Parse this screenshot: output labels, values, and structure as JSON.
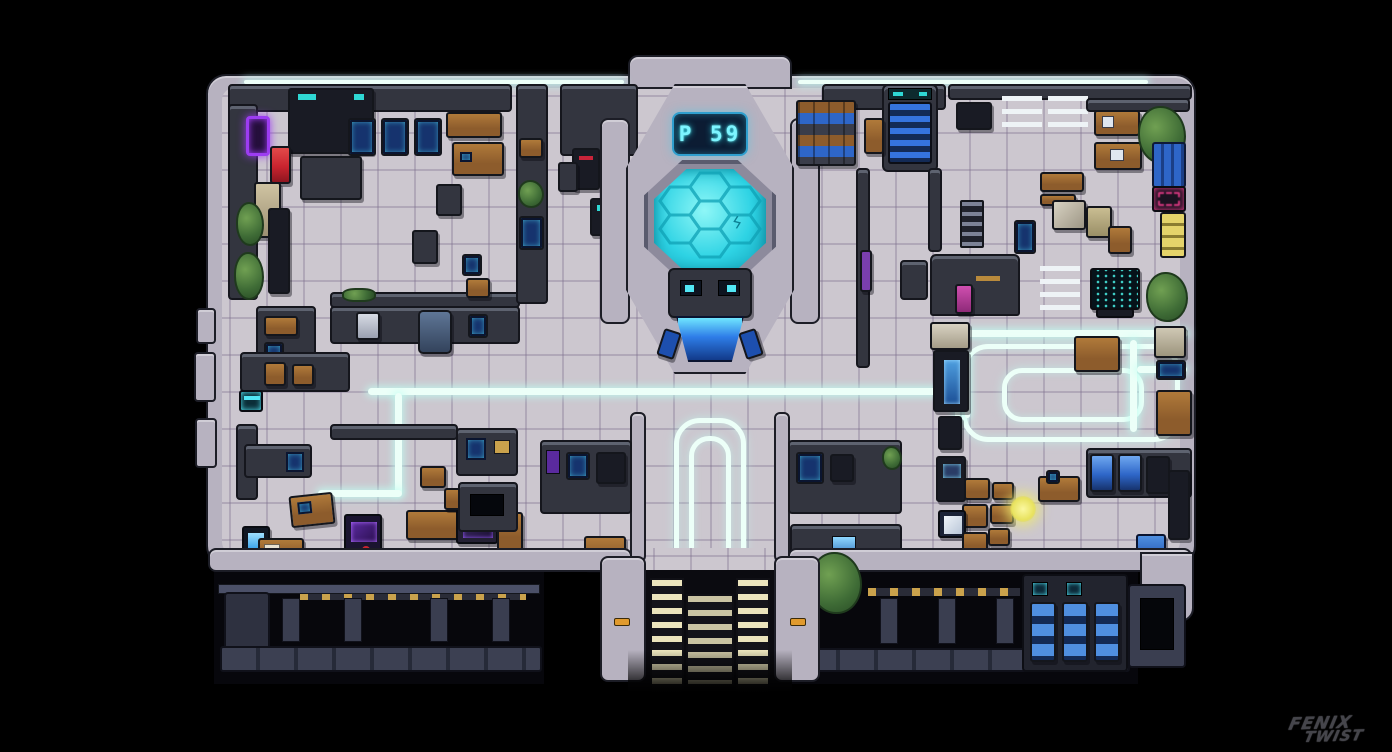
{
  "scene": {
    "title": "Sci-fi space station pixel-art floor map",
    "signature_line1": "FENIX",
    "signature_line2": "TWIST"
  },
  "chamber": {
    "status_display": "P 59"
  },
  "colors": {
    "background": "#000000",
    "floor": "#ccc7cf",
    "wall_dark": "#33353f",
    "wall_edge": "#15161d",
    "wall_light": "#b7b2c0",
    "glow": "#ecfff8",
    "accent_cyan": "#52e7f5",
    "pool_teal": "#2ed3e4",
    "display_text": "#7df5ff",
    "stair_blue": "#3573dd",
    "locker_blue": "#2e66c8",
    "wood": "#8d5c2c",
    "wood_light": "#b07a3a",
    "neon_purple": "#9d3cf2",
    "neon_pink": "#e23a86",
    "alert_red": "#c9242f",
    "step_cream": "#ece5bd",
    "hazard_orange": "#e09a2d",
    "plant_green": "#44703a",
    "basement_wall": "#2e3140",
    "black": "#050508",
    "yellow_glow": "#f2ef7a"
  }
}
